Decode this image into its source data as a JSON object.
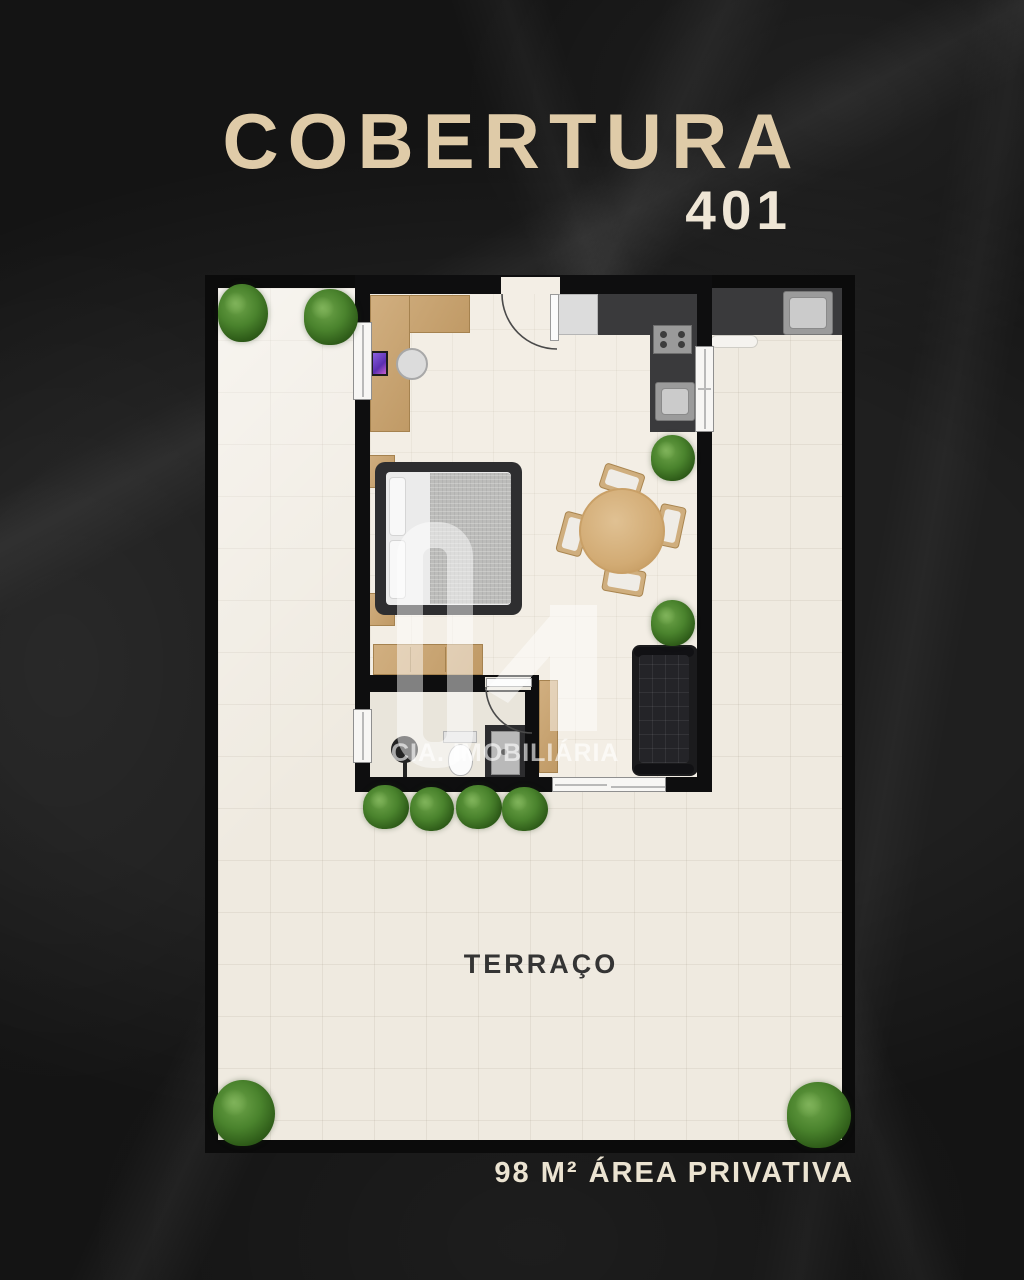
{
  "poster": {
    "title": "COBERTURA",
    "unit_number": "401",
    "area_caption": "98 M² ÁREA PRIVATIVA"
  },
  "floor_plan": {
    "room_label": "TERRAÇO",
    "watermark": {
      "company": "CIA. IMOBILIÁRIA",
      "logo_mark": "rounded-square-and-1-monogram"
    },
    "furniture_icons": [
      "desk",
      "desk-chair",
      "computer",
      "entry-door",
      "fridge",
      "kitchen-counter",
      "stove",
      "kitchen-sink",
      "service-counter",
      "service-sink",
      "service-window",
      "bench",
      "double-bed",
      "pillow",
      "nightstand",
      "dresser",
      "dining-table",
      "dining-chair",
      "sofa",
      "side-cabinet",
      "bathroom-door",
      "toilet",
      "shower",
      "floor-lamp",
      "sliding-door",
      "window",
      "plant"
    ]
  },
  "colors": {
    "background": "#1f1f1f",
    "title_text": "#dfcba8",
    "unit_number_text": "#efe6d6",
    "caption_text": "#ebe3d1",
    "plan_border": "#0b0b0b",
    "terrace_floor": "#efeae0",
    "unit_floor": "#f3eee5",
    "wall": "#0e0e0f",
    "counter_dark": "#3a3a3c",
    "wood": "#c9a56f",
    "plant_green": "#4a832d",
    "room_label_text": "#343434",
    "watermark_white": "rgba(255,255,255,0.55)"
  }
}
